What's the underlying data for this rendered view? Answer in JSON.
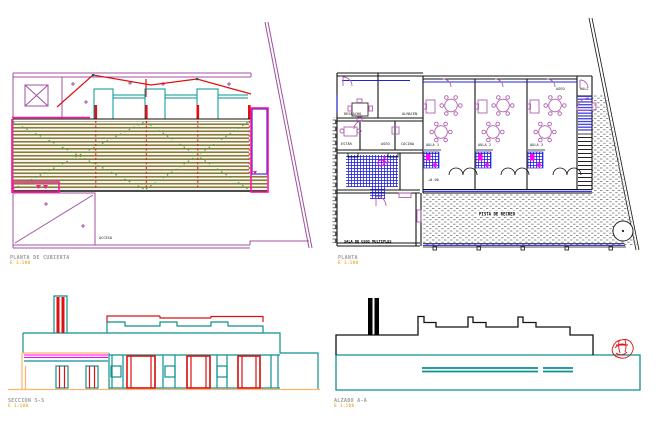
{
  "app": {
    "type": "cad-architectural-sheet",
    "background": "#ffffff"
  },
  "colors": {
    "purple": "#a050a0",
    "pink": "#ff14a0",
    "red": "#dd1111",
    "olive": "#8a7a38",
    "green": "#2db82d",
    "blue": "#2020dd",
    "teal": "#009494",
    "teal2": "#0d9191",
    "furn": "#b060b0",
    "magb": "#ff00ff",
    "orange": "#ffb36b",
    "stipple": "#909090",
    "titleGray": "#9c9c9c",
    "titleYellow": "#e8b64c",
    "label": "#1a1a1a"
  },
  "drawings": {
    "roof_plan": {
      "title": "PLANTA DE CUBIERTA",
      "scale": "E 1:100",
      "site_label": "ACCESO"
    },
    "floor_plan": {
      "title": "PLANTA",
      "scale": "E 1:100",
      "labels": {
        "office": "DESPACHO",
        "store": "ALMACEN",
        "living": "ESTAR",
        "toilet": "ASEO",
        "kitchen": "COCINA",
        "aula1": "AULA 1",
        "aula2": "AULA 2",
        "aula3": "AULA 3",
        "level": "+0.00",
        "toilet2": "ASEO",
        "hall": "HALL",
        "terrace": "PISTA DE RECREO",
        "multi": "SALA DE USOS MULTIPLES"
      }
    },
    "section": {
      "title": "SECCION S-S",
      "scale": "E 1:100"
    },
    "elevation": {
      "title": "ALZADO A-A",
      "scale": "E 1:100"
    }
  }
}
